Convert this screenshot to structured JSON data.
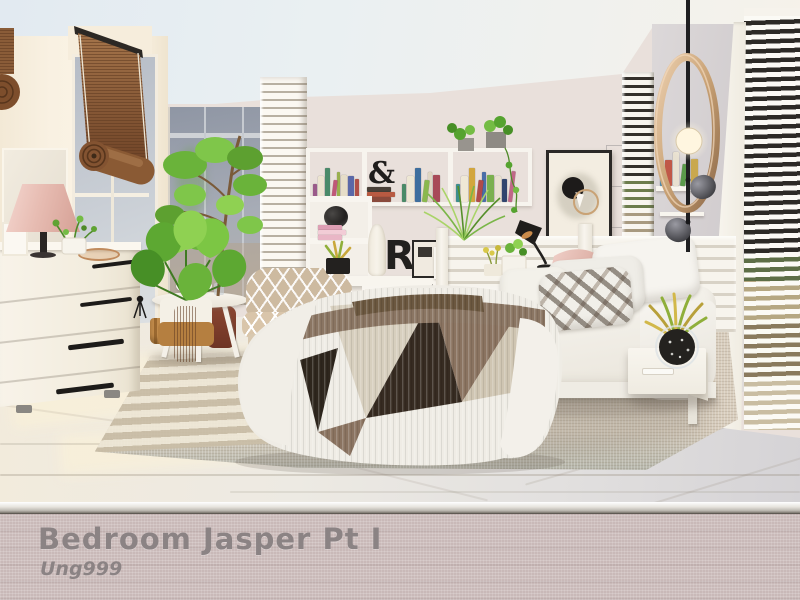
{
  "banner": {
    "title": "Bedroom Jasper Pt I",
    "author": "Ung999"
  },
  "scene": {
    "description": "Sims-style rendered bedroom in white, cream and natural wood tones with plants, bamboo blind, slatted partitions and a geometric-print blanket",
    "decor": {
      "ampersand": "&",
      "letter_r": "R"
    }
  },
  "shelf": {
    "books": {
      "top_left": [
        "#9a5a8a",
        "#ece4d0",
        "#4a8a6a",
        "#c05878",
        "#9ab04e",
        "#e6ddc8",
        "#5a68a8",
        "#b05048"
      ],
      "top_mid": [
        "#4a8a68",
        "#eee7d4",
        "#3e6e9e",
        "#8ab84e",
        "#ded5c2",
        "#a84a58"
      ],
      "top_right": [
        "#3e8e8e",
        "#efe8d6",
        "#d2a63e",
        "#b04a4a",
        "#4a6ea8",
        "#7ab04e",
        "#e8e1cf",
        "#31456e",
        "#c06888"
      ],
      "lower": [
        "#d86888",
        "#b03858",
        "#c84848",
        "#2e2a28",
        "#e8e0ce",
        "#6a4a88"
      ],
      "pink_stack": [
        "#e9b6c6",
        "#f2ccd6",
        "#de9fb4"
      ],
      "amp_stack": [
        "#8a4a3c",
        "#b85a42",
        "#4a4038"
      ],
      "column_shelf": [
        "#4a8ab0",
        "#c05848",
        "#e8e0d0",
        "#5a9a4a",
        "#2a4a7a",
        "#c9a84e"
      ]
    }
  },
  "colors": {
    "banner_bg": "#c9b9b8",
    "banner_text": "#8b8384",
    "wall_cream": "#f9f1e2",
    "wall_back": "#e9e0db",
    "floor_warm": "#f2ebdc",
    "floor_cool": "#d5d3d6",
    "rug_base": "#d8cdbd",
    "bamboo": "#8a5c36",
    "plant_green": "#62a832",
    "copper": "#c9a275",
    "blanket_taupe": "#8a7360",
    "blanket_dark": "#342a20"
  }
}
